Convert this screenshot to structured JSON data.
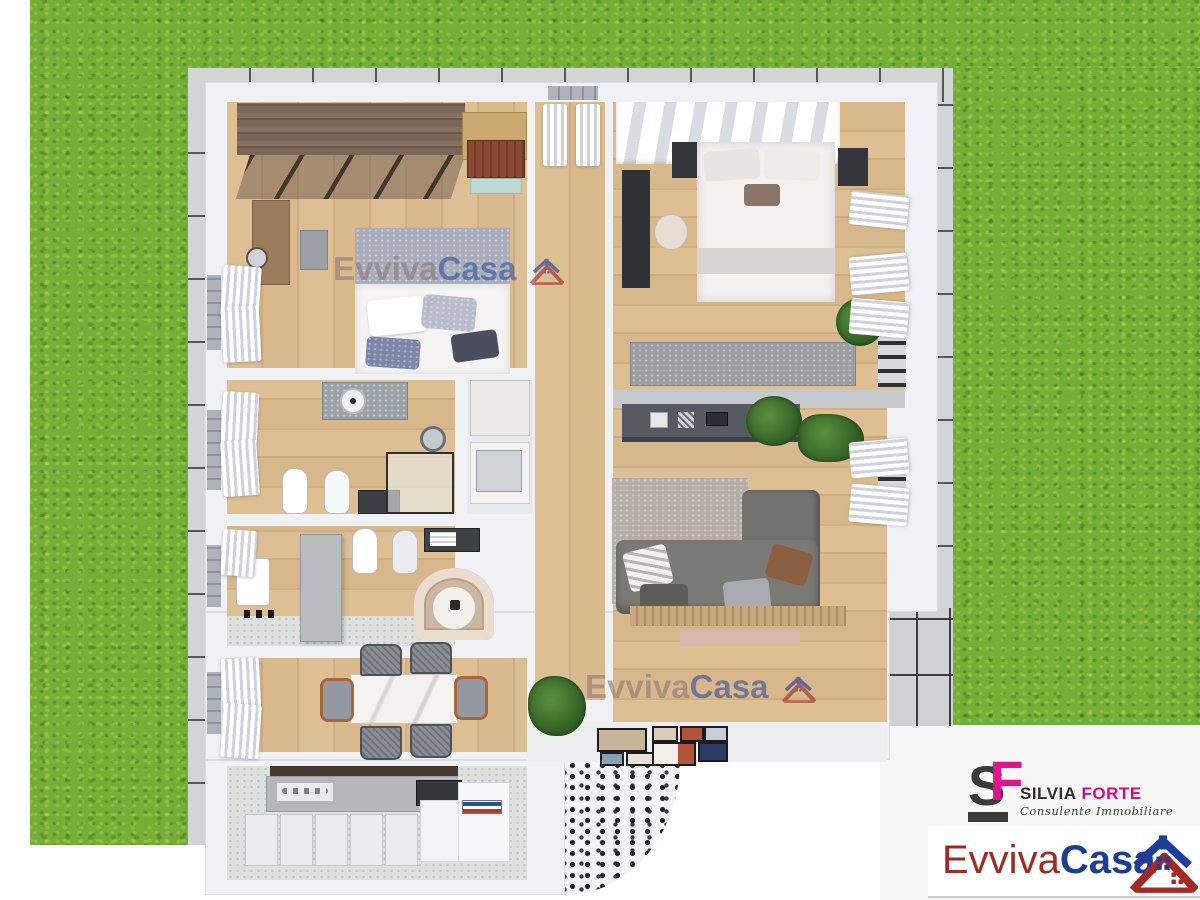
{
  "scene": {
    "type": "3D apartment floor plan render, top-down view",
    "setting": "apartment with two bedrooms, two bathrooms, living room, dining area and kitchen, surrounded by lawn, paved border and a tiled corner patio"
  },
  "watermark": {
    "part1": "Evviva",
    "part2": "Casa",
    "icon": "twin-houses-icon",
    "opacity": 0.62
  },
  "agency_logo": {
    "monogram_s": "S",
    "monogram_f": "F",
    "name_first": "SILVIA",
    "name_last": "FORTE",
    "tagline": "Consulente Immobiliare"
  },
  "brand_logo": {
    "part1": "Evviva",
    "part2": "Casa",
    "icon": "twin-houses-icon"
  },
  "colors": {
    "grass": "#74ae36",
    "paving": "#d3d4d6",
    "wood_floor": "#d9ba8e",
    "wall": "#f0f1f4",
    "brand_red": "#a32a22",
    "brand_blue": "#1e3c9c",
    "accent_magenta": "#e8118c",
    "dark_text": "#3a3a3a"
  },
  "rooms": [
    {
      "name": "bedroom-main",
      "furniture": [
        "wardrobe",
        "glass-sliding-doors",
        "double-bed",
        "vanity-desk",
        "stool",
        "chest",
        "trunk",
        "curtains"
      ]
    },
    {
      "name": "bedroom-second",
      "furniture": [
        "striped-closet",
        "double-bed",
        "nightstands",
        "desk",
        "chair",
        "storage-bench",
        "plant",
        "curtains"
      ]
    },
    {
      "name": "hallway",
      "furniture": [
        "curtained-window"
      ]
    },
    {
      "name": "bathroom-main",
      "furniture": [
        "marble-washbasin",
        "round-mirror",
        "toilet",
        "bidet",
        "glass-shower"
      ]
    },
    {
      "name": "bathroom-second",
      "furniture": [
        "toilet",
        "bidet",
        "round-bathtub",
        "washbasin",
        "towel-shelf",
        "partition"
      ]
    },
    {
      "name": "dining-room",
      "furniture": [
        "marble-table",
        "six-chairs",
        "curtains"
      ]
    },
    {
      "name": "kitchen",
      "furniture": [
        "dark-countertop",
        "cooktop",
        "base-cabinets",
        "tall-cabinet",
        "books"
      ]
    },
    {
      "name": "living-room",
      "furniture": [
        "tv-sideboard",
        "rug",
        "corner-sofa",
        "cushions",
        "plants",
        "wood-deck"
      ]
    },
    {
      "name": "entry",
      "furniture": [
        "picture-frames",
        "palm-plant",
        "mosaic-curved-wall"
      ]
    }
  ]
}
